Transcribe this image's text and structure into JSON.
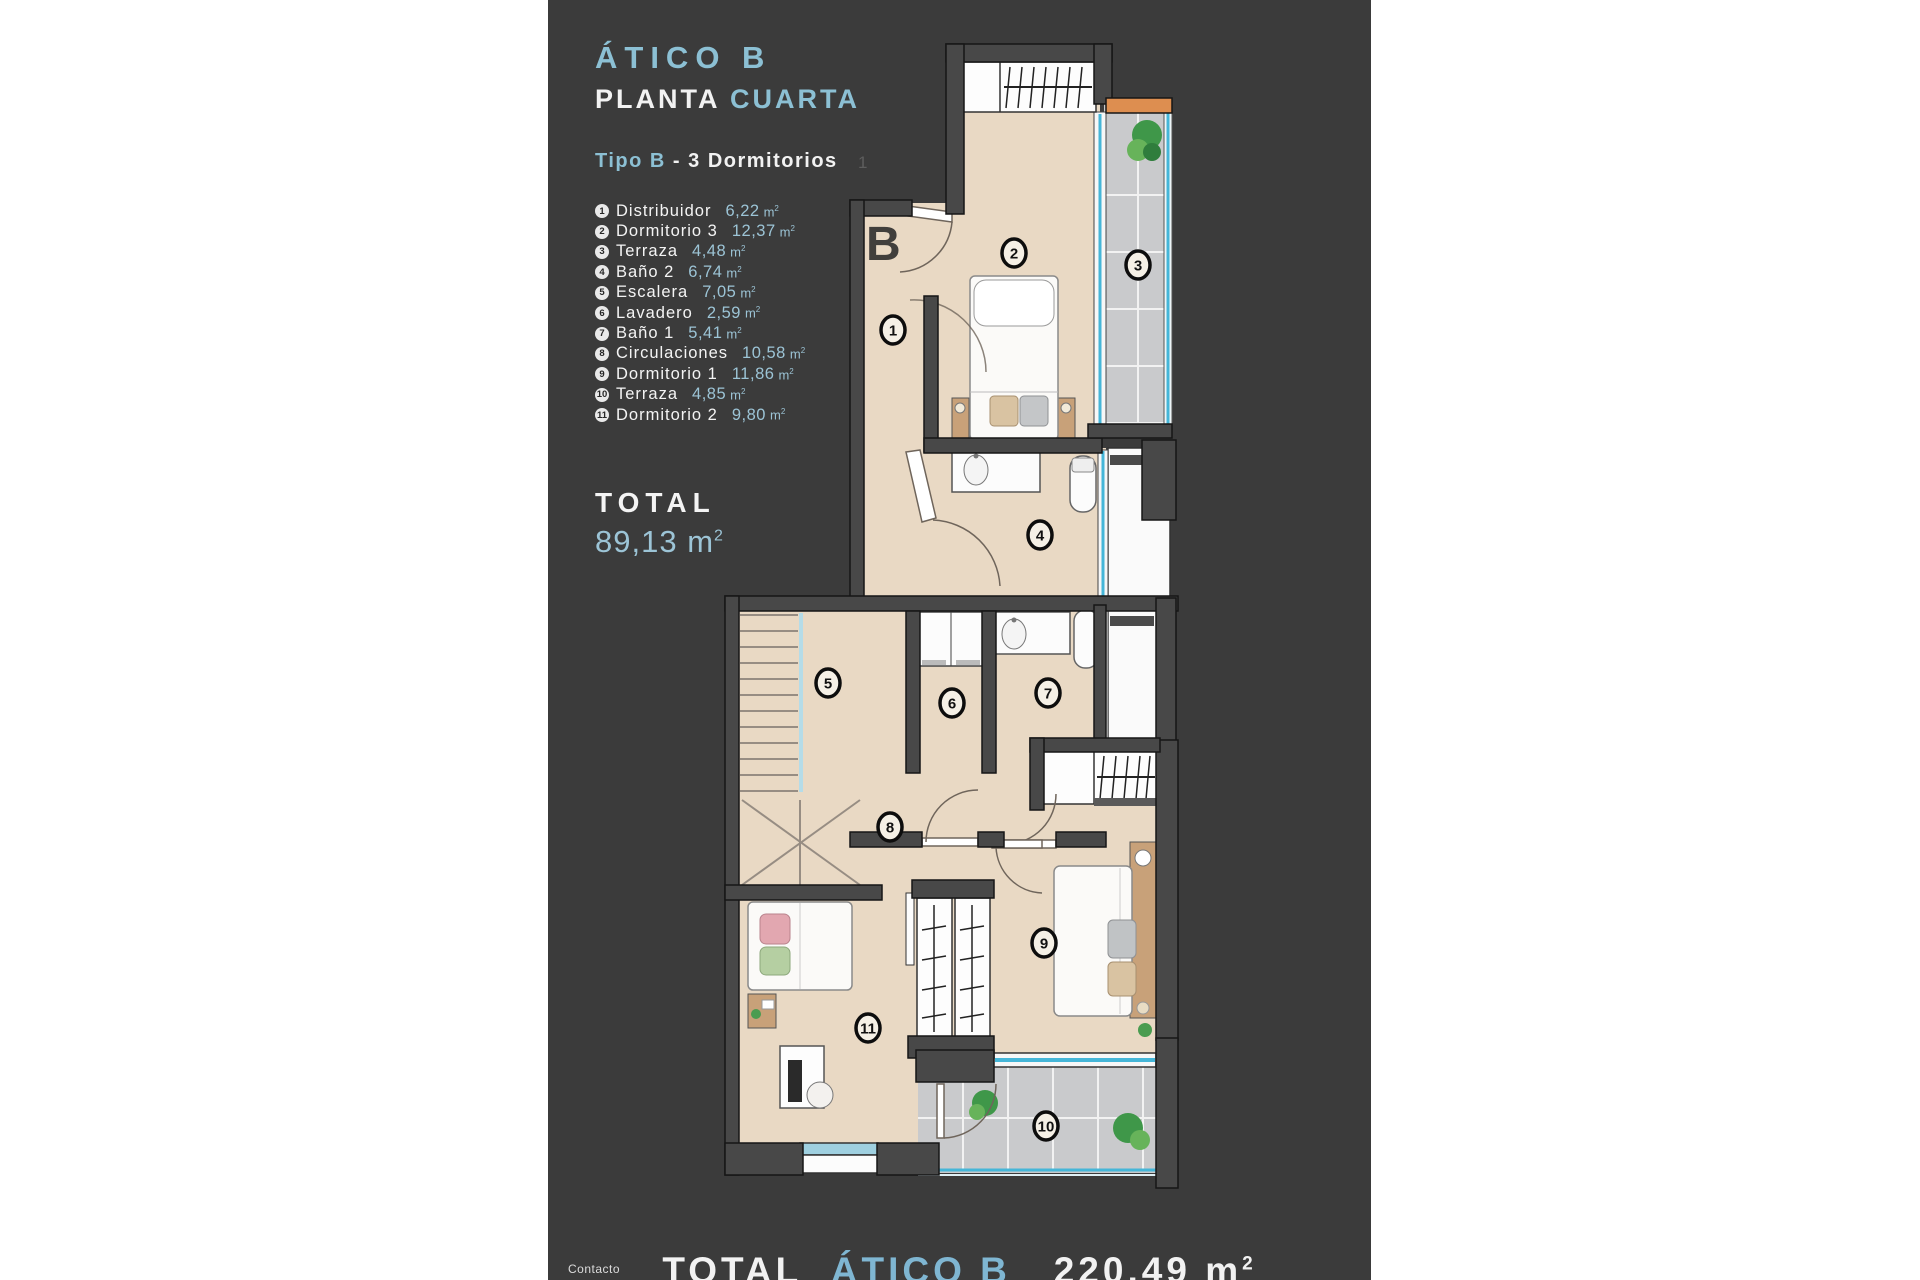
{
  "colors": {
    "accent": "#8cc0d4",
    "panel_bg": "#3b3b3b",
    "floor": "#e9d9c4",
    "tile": "#c9cacc",
    "glass": "#45b6d8",
    "beam": "#dd8e50"
  },
  "header": {
    "title": "ÁTICO B",
    "plant_white": "PLANTA",
    "plant_accent": "CUARTA"
  },
  "type_line": {
    "accent": "Tipo B",
    "rest": "-  3  Dormitorios"
  },
  "legend": {
    "unit": "m",
    "unit_sup": "2",
    "items": [
      {
        "num": "1",
        "name": "Distribuidor",
        "area": "6,22"
      },
      {
        "num": "2",
        "name": "Dormitorio 3",
        "area": "12,37"
      },
      {
        "num": "3",
        "name": "Terraza",
        "area": "4,48"
      },
      {
        "num": "4",
        "name": "Baño 2",
        "area": "6,74"
      },
      {
        "num": "5",
        "name": "Escalera",
        "area": "7,05"
      },
      {
        "num": "6",
        "name": "Lavadero",
        "area": "2,59"
      },
      {
        "num": "7",
        "name": "Baño 1",
        "area": "5,41"
      },
      {
        "num": "8",
        "name": "Circulaciones",
        "area": "10,58"
      },
      {
        "num": "9",
        "name": "Dormitorio 1",
        "area": "11,86"
      },
      {
        "num": "10",
        "name": "Terraza",
        "area": "4,85"
      },
      {
        "num": "11",
        "name": "Dormitorio 2",
        "area": "9,80"
      }
    ]
  },
  "total": {
    "label": "TOTAL",
    "value": "89,13",
    "unit": "m",
    "unit_sup": "2"
  },
  "footer": {
    "label": "TOTAL",
    "accent": "ÁTICO B",
    "value": "220,49",
    "unit": "m",
    "unit_sup": "2"
  },
  "contact": {
    "label": "Contacto"
  },
  "plan": {
    "letter": "B",
    "faint_label": "1",
    "markers": [
      {
        "num": "1",
        "x": 893,
        "y": 330
      },
      {
        "num": "2",
        "x": 1014,
        "y": 253
      },
      {
        "num": "3",
        "x": 1138,
        "y": 265
      },
      {
        "num": "4",
        "x": 1040,
        "y": 535
      },
      {
        "num": "5",
        "x": 828,
        "y": 683
      },
      {
        "num": "6",
        "x": 952,
        "y": 703
      },
      {
        "num": "7",
        "x": 1048,
        "y": 693
      },
      {
        "num": "8",
        "x": 890,
        "y": 827
      },
      {
        "num": "9",
        "x": 1044,
        "y": 943
      },
      {
        "num": "10",
        "x": 1046,
        "y": 1126
      },
      {
        "num": "11",
        "x": 868,
        "y": 1028
      }
    ]
  }
}
